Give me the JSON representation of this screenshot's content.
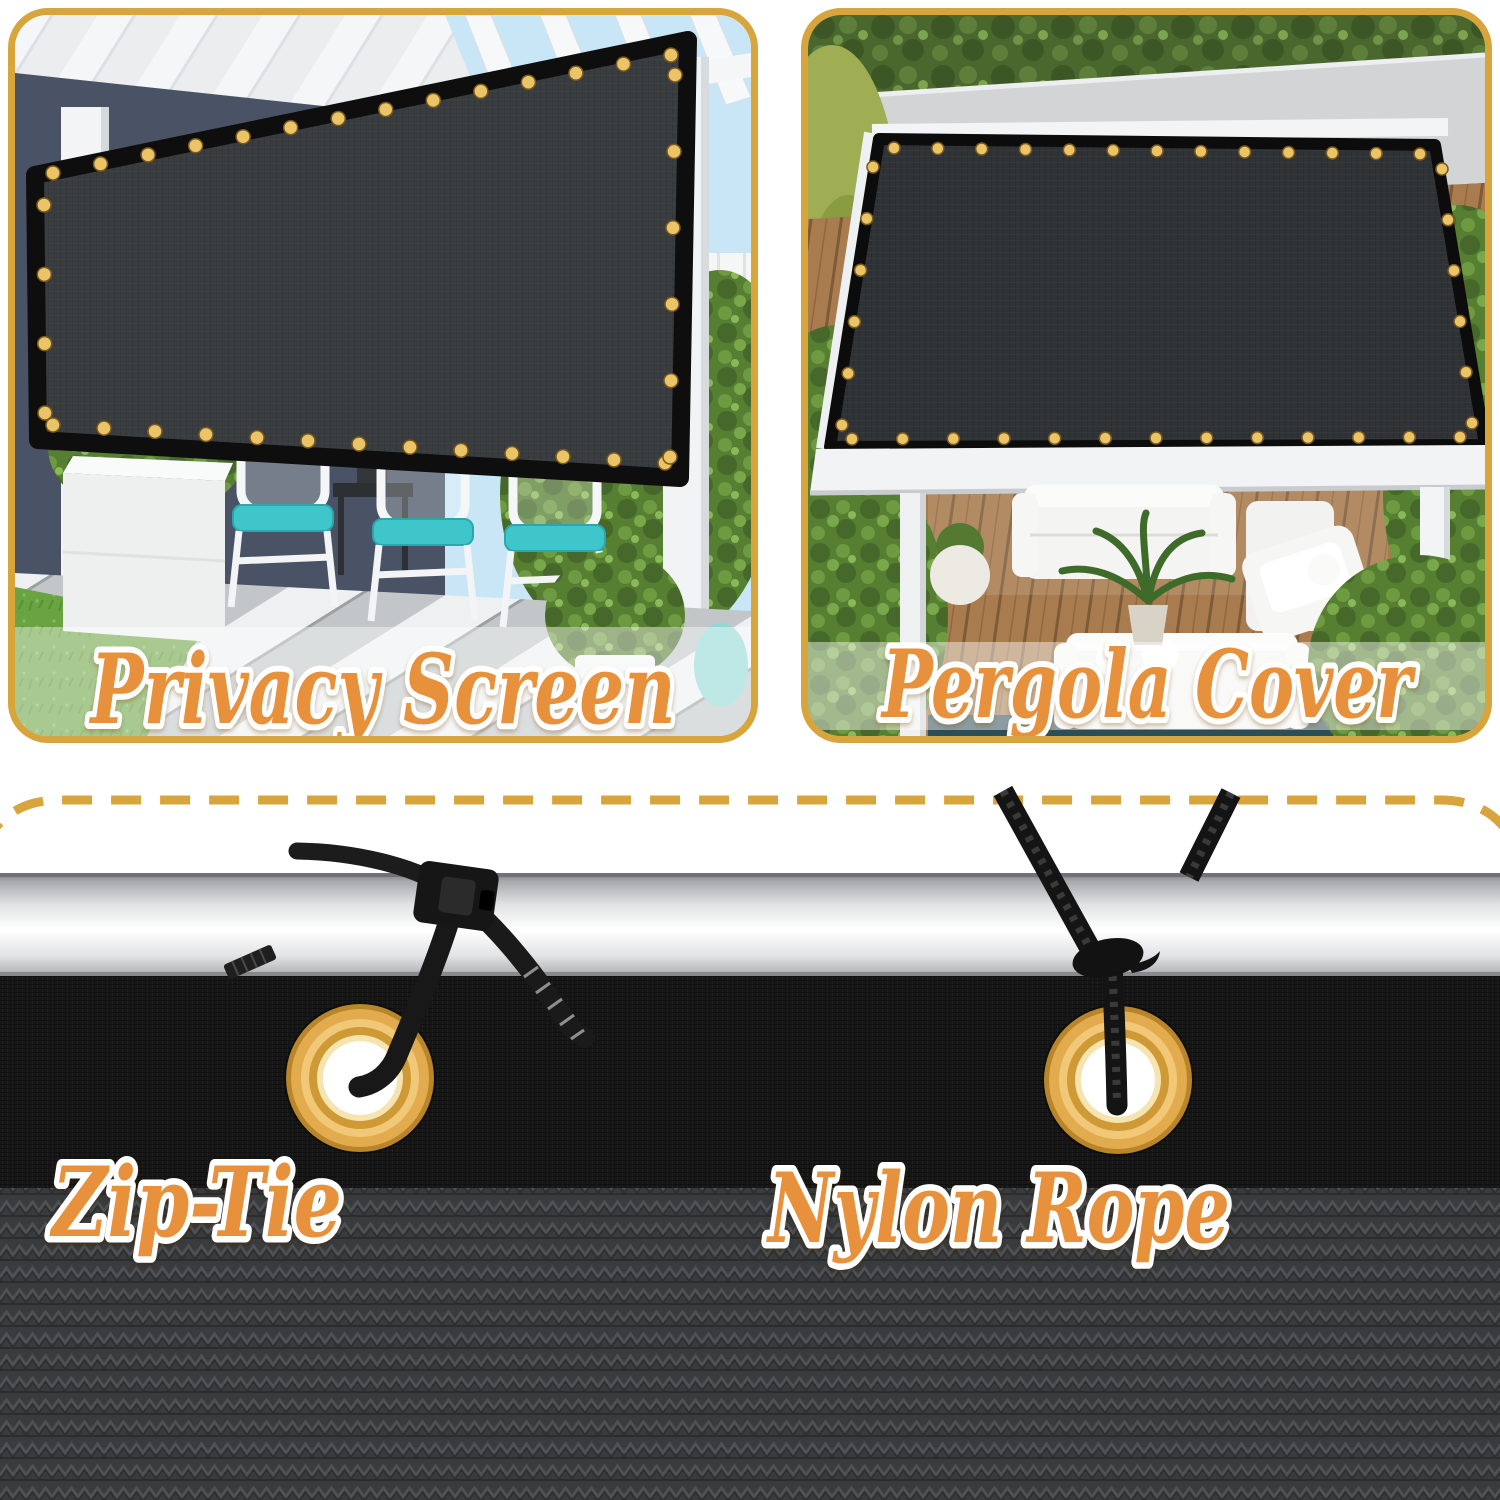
{
  "theme": {
    "gold": "#D8A43C",
    "orange": "#E8913C",
    "grommet": "#E2AC4E",
    "mesh": "#161616",
    "fabric": "#3A3C3E",
    "pole": "#E8EAEC",
    "screen": "#3A3D40"
  },
  "panels": {
    "privacy": {
      "caption": "Privacy Screen"
    },
    "pergola": {
      "caption": "Pergola Cover"
    }
  },
  "fasteners": {
    "zip_tie": {
      "label": "Zip-Tie"
    },
    "nylon_rope": {
      "label": "Nylon Rope"
    }
  }
}
